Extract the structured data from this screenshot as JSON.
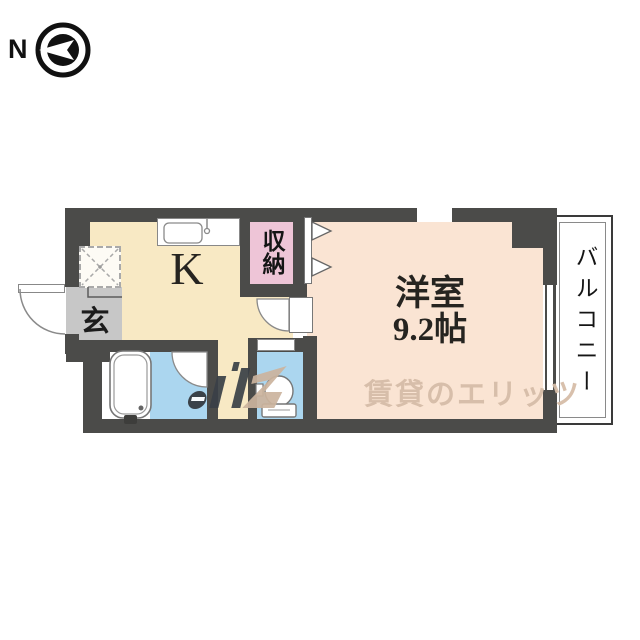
{
  "compass": {
    "north_label": "N"
  },
  "rooms": {
    "kitchen": {
      "label": "K"
    },
    "entrance": {
      "label": "玄"
    },
    "closet": {
      "label": "収納"
    },
    "western_room": {
      "label": "洋室",
      "size": "9.2帖"
    },
    "balcony": {
      "label": "バルコニー"
    }
  },
  "watermark": {
    "text": "賃貸のエリッツ"
  },
  "colors": {
    "wall": "#4b4b49",
    "kitchen_floor": "#f8e9c4",
    "western_room_floor": "#fae4d3",
    "closet_floor": "#eec5d7",
    "wet_area_floor": "#abd6ef",
    "entrance_floor": "#c7c7c7",
    "watermark_text": "#d6bda8",
    "watermark_logo_dark": "#3a4047"
  }
}
